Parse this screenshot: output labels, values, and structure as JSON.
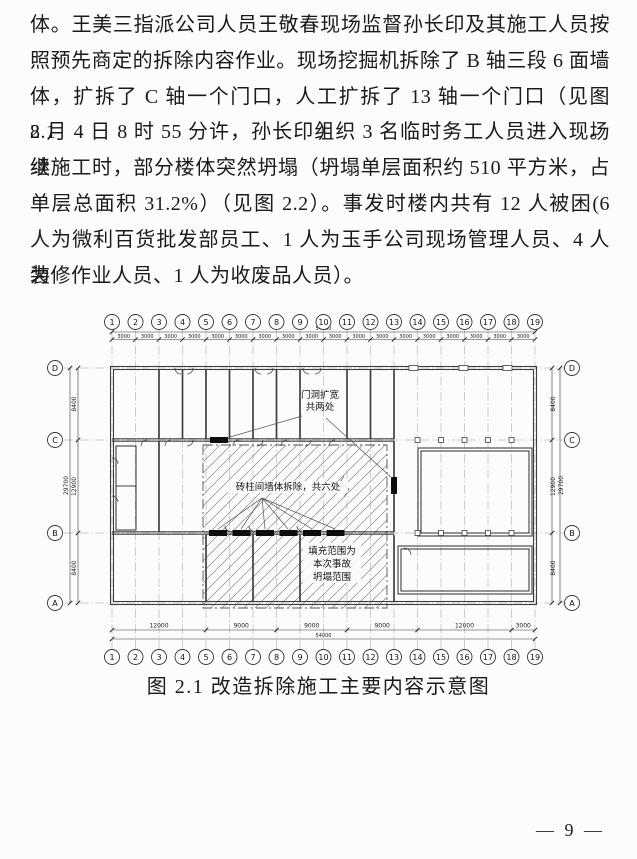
{
  "page": {
    "paragraph_lines": [
      "体。王美三指派公司人员王敬春现场监督孙长印及其施工人员按",
      "照预先商定的拆除内容作业。现场挖掘机拆除了 B 轴三段 6 面墙",
      "体，扩拆了 C 轴一个门口，人工扩拆了 13 轴一个门口（见图 2.1）。",
      "8 月 4 日 8 时 55 分许，孙长印组织 3 名临时务工人员进入现场继",
      "续施工时，部分楼体突然坍塌（坍塌单层面积约 510 平方米，占",
      "单层总面积 31.2%）（见图 2.2）。事发时楼内共有 12 人被困(6",
      "人为微利百货批发部员工、1 人为玉手公司现场管理人员、4 人为",
      "装修作业人员、1 人为收废品人员）。"
    ],
    "figure_caption": "图 2.1 改造拆除施工主要内容示意图",
    "page_number": "— 9 —"
  },
  "figure": {
    "axes_top": [
      "1",
      "2",
      "3",
      "4",
      "5",
      "6",
      "7",
      "8",
      "9",
      "10",
      "11",
      "12",
      "13",
      "14",
      "15",
      "16",
      "17",
      "18",
      "19"
    ],
    "axes_bottom": [
      "1",
      "2",
      "3",
      "4",
      "5",
      "6",
      "7",
      "8",
      "9",
      "10",
      "11",
      "12",
      "13",
      "14",
      "15",
      "16",
      "17",
      "18",
      "19"
    ],
    "axes_left": [
      "D",
      "C",
      "B",
      "A"
    ],
    "axes_right": [
      "D",
      "C",
      "B",
      "A"
    ],
    "dims": {
      "top_total": "54000",
      "top_segment": "3000",
      "bottom_segments": [
        "12000",
        "9000",
        "9000",
        "9000",
        "12000",
        "3000"
      ],
      "bottom_total": "54000",
      "left_segments": [
        "8400",
        "12900",
        "8400"
      ],
      "left_total": "29700",
      "right_segments": [
        "8400",
        "12900",
        "8400"
      ],
      "right_total": "29700"
    },
    "annotations": {
      "door_widen": [
        "门洞扩宽",
        "共两处"
      ],
      "wall_demolish": "砖柱间墙体拆除，共六处",
      "collapse_fill": [
        "填充范围为",
        "本次事故",
        "坍塌范围"
      ]
    }
  }
}
